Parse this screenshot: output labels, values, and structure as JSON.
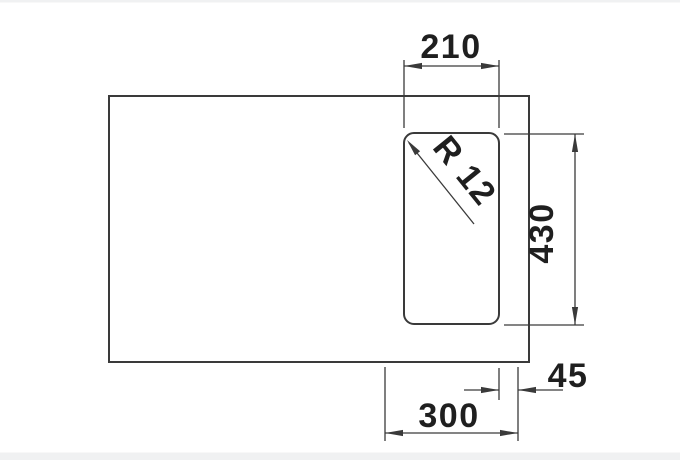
{
  "drawing": {
    "title": "sink-bowl-cutout-dimension-drawing",
    "units": "mm",
    "dimensions": {
      "top_width": "210",
      "right_height": "430",
      "corner_radius": "R 12",
      "bottom_offset": "45",
      "bottom_width": "300"
    },
    "shapes": {
      "outer_rectangle": "sink outline",
      "inner_rounded_rectangle": "bowl outline"
    }
  },
  "colors": {
    "line": "#3a3a3a",
    "text": "#1f1f1f",
    "frame": "#f0f1f2",
    "background": "#ffffff"
  }
}
